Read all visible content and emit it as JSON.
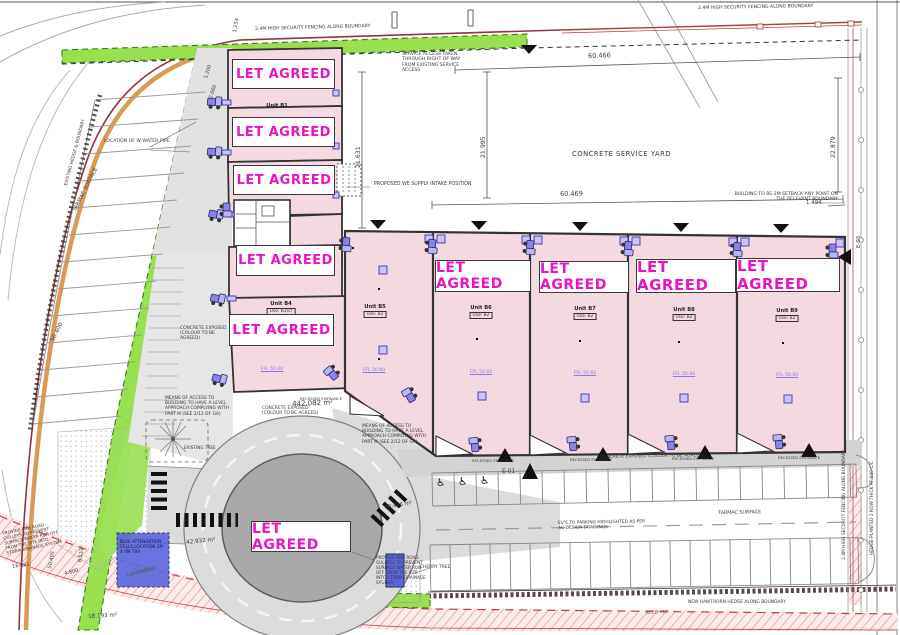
{
  "stamp": "LET AGREED",
  "units": {
    "b1": {
      "name": "Unit B1"
    },
    "b4": {
      "name": "Unit B4",
      "use": "Use: B1(c)"
    },
    "b5": {
      "name": "Unit B5",
      "use": "Use: B2"
    },
    "b6": {
      "name": "Unit B6",
      "use": "Use: B2"
    },
    "b7": {
      "name": "Unit B7",
      "use": "Use: B2"
    },
    "b8": {
      "name": "Unit B8",
      "use": "Use: B2"
    },
    "b9": {
      "name": "Unit B9",
      "use": "Use: B2"
    },
    "ffl": "FFL 50.60"
  },
  "notes": {
    "fence": "2.4M HIGH SECURITY FENCING ALONG BOUNDARY",
    "service_access": "SERVICE ACCESS TAKEN THROUGH RIGHT OF WAY FROM EXISTING SERVICE ACCESS",
    "water_pipe": "LOCATION OF W WATER PIPE",
    "supply_intake": "PROPOSED WE SUPPLY INTAKE POSITION",
    "service_yard": "CONCRETE SERVICE YARD",
    "setback": "BUILDING TO BE 2M SETBACK ANY POINT ON THE RELEVANT BOUNDARY",
    "means_access": "MEANS OF ACCESS TO BUILDING TO HAVE A LEVEL APPROACH COMPLYING WITH PART M (SEE 2/12 OF GA)",
    "concrete_exposed": "CONCRETE EXPOSED (COLOUR TO BE AGREED)",
    "recessed": "RECESSED ENTRANCE",
    "tarmac": "TARMAC SURFACE",
    "ev_parking": "EV'S TO PARKING HIGHLIGHTED AS PER AC DESIGN DRAWINGS",
    "hawthorn": "NEW HAWTHORN HEDGE ALONG BOUNDARY",
    "seed_mix": "SEED MIX",
    "hedge_right": "HEDGE PLANTED 2 ROW THICK AT 600 C/C",
    "left_boundary": "EXISTING HEDGE & BOUNDARY",
    "gulleys": "PROVIDE 8NO ROAD GULLEYS TO PREVENT SURFACE WATER RUN OFF FROM THE SITE INTO STORM DRAINAGE SYSTEM",
    "attenuation": "BLUE ATTENUATION CELLS LOCATION 2M X 4M TBA",
    "flowerbeds": "FLOWERBEDS",
    "cherry": "CHERRY TREE",
    "existing_tree": "EXISTING TREE",
    "e01": "E-01",
    "e03": "E-03"
  },
  "dims": {
    "d60466": "60.466",
    "d60469": "60.469",
    "d21631": "21.631",
    "d21995": "21.995",
    "d22879": "22.879",
    "d1494": "1.494",
    "d1254": "1.254",
    "d1200": "1.200",
    "d2060": "2.060",
    "d50400": "50.400",
    "d50405": "50.405",
    "d16481": "16.481",
    "d8523": "8.523",
    "d4800": "4.800"
  },
  "areas": {
    "yard": "442.082 m²",
    "roundabout": "68.486 m²",
    "landscape": "42.932 m²",
    "corner": "18.193 m²"
  },
  "glyphs": {
    "wheelchair": "♿"
  },
  "colors": {
    "unit_fill": "#f4d9e1",
    "stamp_text": "#ea14c4",
    "landscape_green": "#98e050",
    "road_gray": "#dcdcdc",
    "island_gray": "#a9a9a9",
    "attenuation_blue": "#5a66dd",
    "boundary_red": "#b23b3b",
    "kerb_orange": "#dc9a58"
  }
}
